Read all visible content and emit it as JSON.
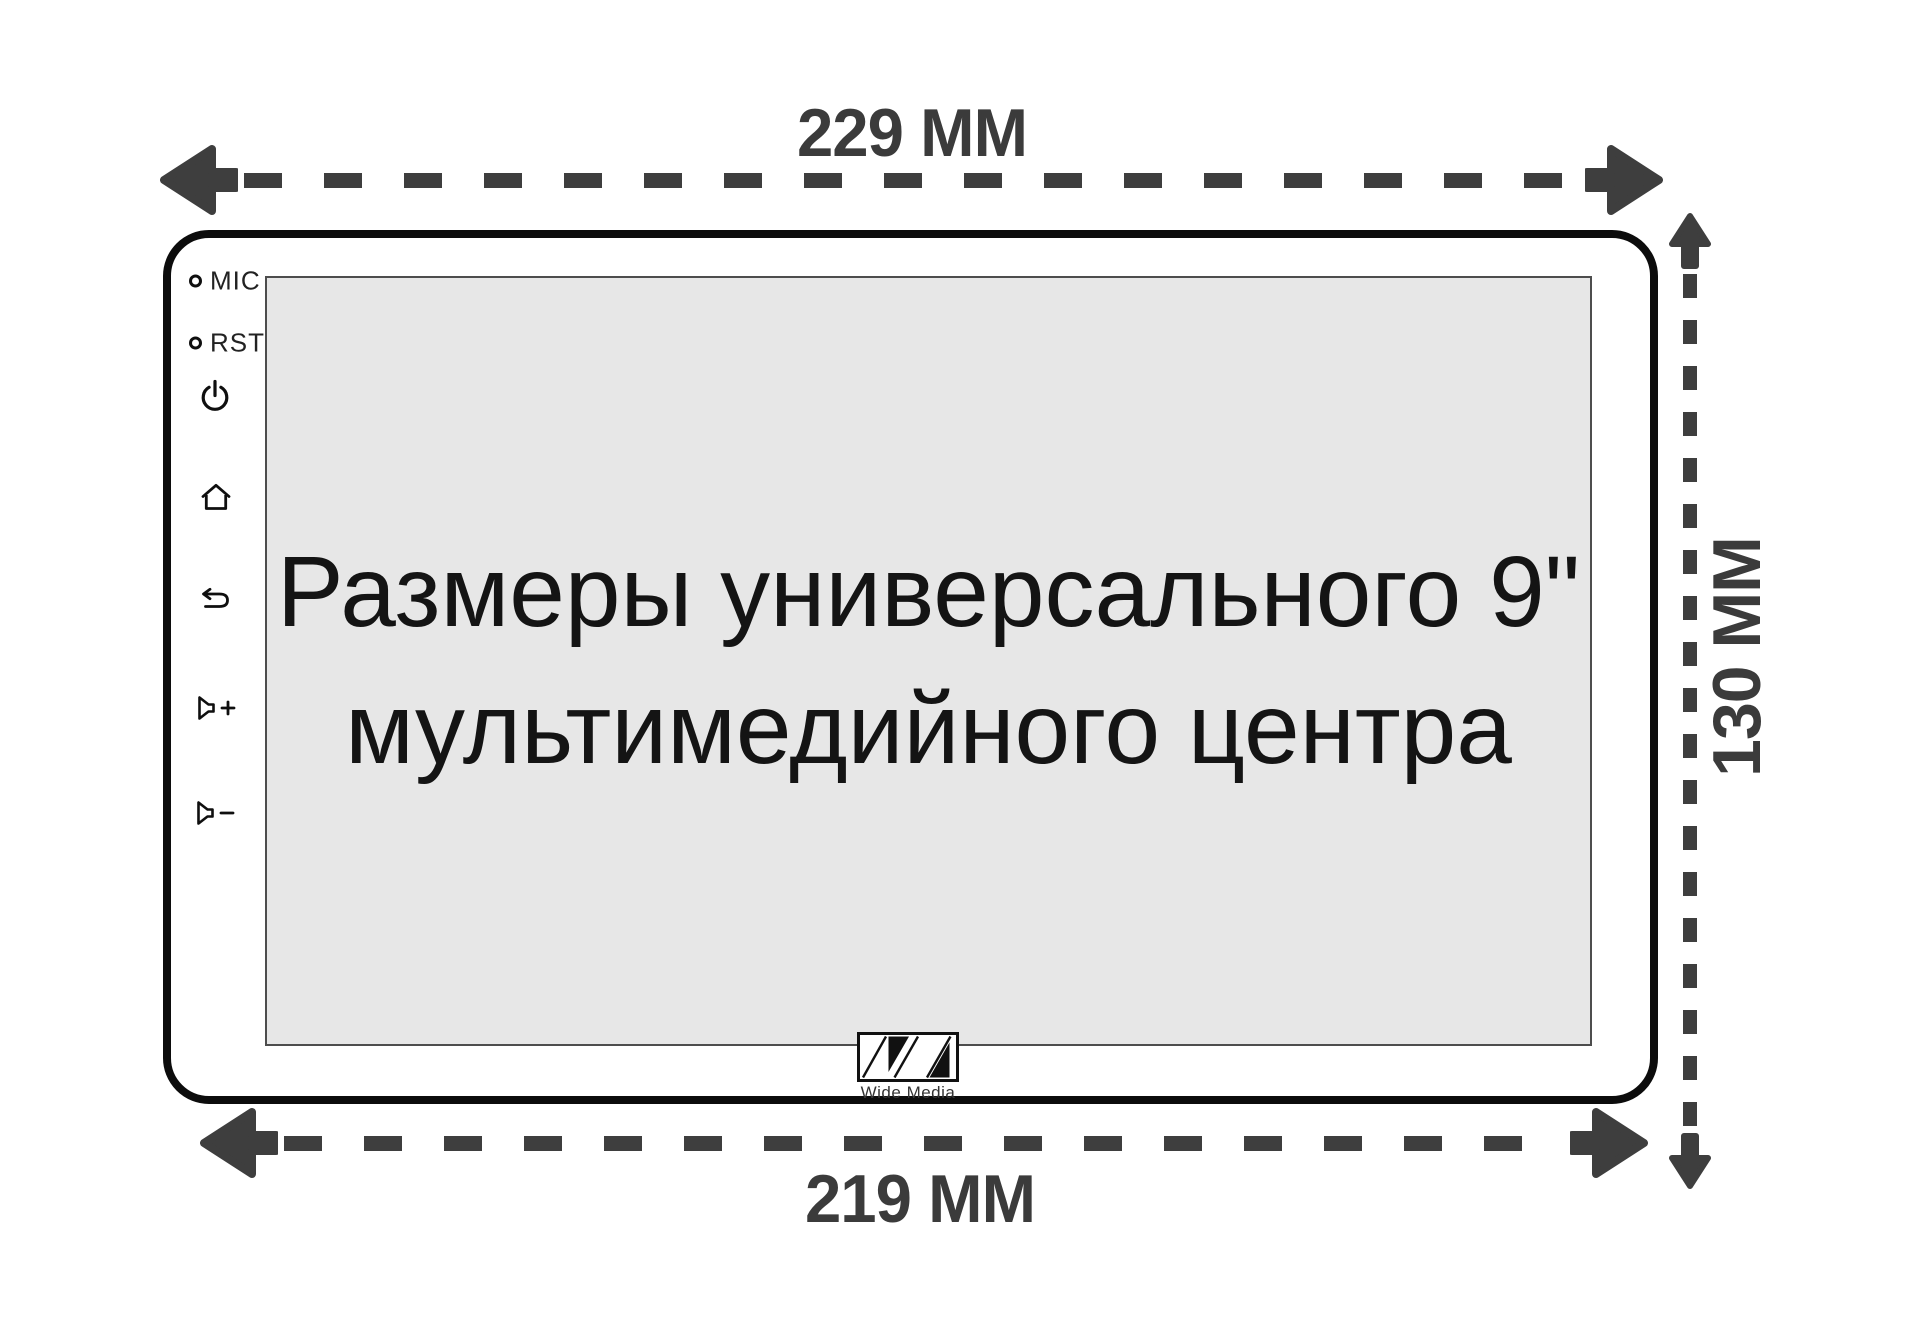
{
  "dimensions": {
    "top_width": "229 ММ",
    "bottom_width": "219 ММ",
    "height": "130 ММ"
  },
  "screen": {
    "title_line1": "Размеры универсального 9\"",
    "title_line2": "мультимедийного центра"
  },
  "controls": {
    "mic_label": "MIC",
    "rst_label": "RST",
    "icons": [
      "power-icon",
      "home-icon",
      "back-icon",
      "volume-up-icon",
      "volume-down-icon"
    ]
  },
  "logo": {
    "brand": "Wide Media"
  },
  "colors": {
    "dimension": "#3e3e3e",
    "outline": "#0c0c0c",
    "screen_bg": "#e7e7e7",
    "screen_border": "#4d4d4d",
    "text": "#141414"
  }
}
